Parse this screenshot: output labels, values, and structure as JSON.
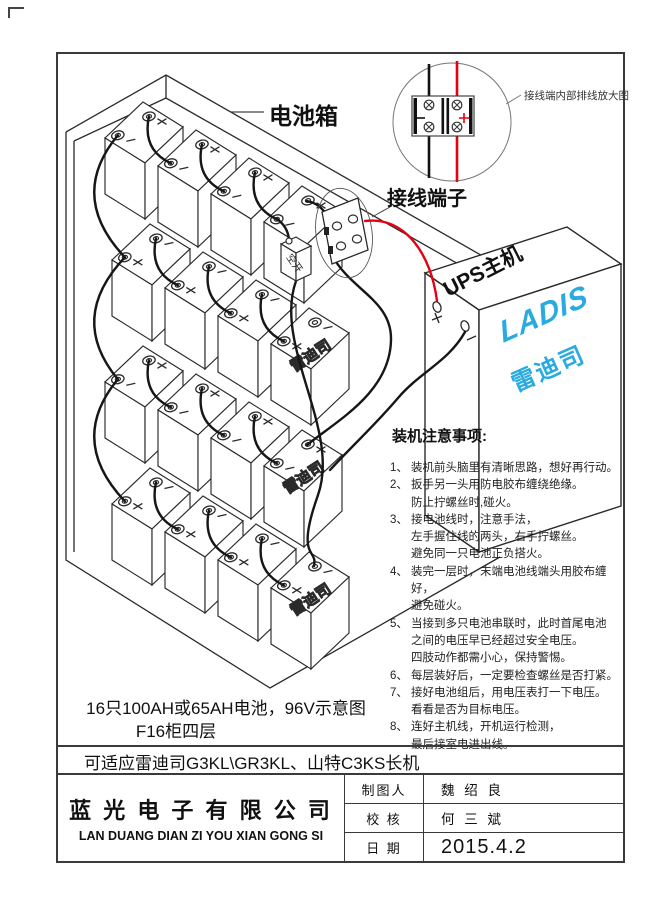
{
  "page": {
    "colors": {
      "line": "#2a2a2a",
      "red_wire": "#e60014",
      "brand_blue": "#29abe2"
    },
    "detail_view": {
      "label": "接线端内部排线放大图",
      "minus": "−",
      "plus": "+"
    },
    "battery_box": {
      "label": "电池箱",
      "battery_brand": "雷迪司"
    },
    "terminal_block": {
      "label": "接线端子"
    },
    "breaker": {
      "label": "空开"
    },
    "ups": {
      "top_label": "UPS主机",
      "logo": "LADIS",
      "brand": "雷迪司",
      "plus": "+",
      "minus": "−"
    },
    "notes": {
      "title": "装机注意事项:",
      "items": [
        {
          "num": "1、",
          "lines": [
            "装机前头脑里有清晰思路，想好再行动。"
          ]
        },
        {
          "num": "2、",
          "lines": [
            "扳手另一头用防电胶布缠绕绝缘。",
            "防止拧螺丝时,碰火。"
          ]
        },
        {
          "num": "3、",
          "lines": [
            "接电池线时，注意手法，",
            "左手握住线的两头，右手拧螺丝。",
            "避免同一只电池正负搭火。"
          ]
        },
        {
          "num": "4、",
          "lines": [
            "装完一层时，末端电池线端头用胶布缠好，",
            "避免碰火。"
          ]
        },
        {
          "num": "5、",
          "lines": [
            "当接到多只电池串联时，此时首尾电池",
            "之间的电压早已经超过安全电压。",
            "四肢动作都需小心，保持警惕。"
          ]
        },
        {
          "num": "6、",
          "lines": [
            "每层装好后，一定要检查螺丝是否打紧。"
          ]
        },
        {
          "num": "7、",
          "lines": [
            "接好电池组后，用电压表打一下电压。",
            "看看是否为目标电压。"
          ]
        },
        {
          "num": "8、",
          "lines": [
            "连好主机线，开机运行检测，",
            "最后接室电进出线。"
          ]
        }
      ]
    },
    "captions": {
      "line1": "16只100AH或65AH电池，96V示意图",
      "line2": "F16柜四层",
      "compat": "可适应雷迪司G3KL\\GR3KL、山特C3KS长机"
    },
    "title_block": {
      "company_cn": "蓝 光 电 子 有 限 公 司",
      "company_en": "LAN DUANG DIAN ZI YOU XIAN GONG SI",
      "rows": [
        {
          "label": "制图人",
          "value": "魏 绍 良"
        },
        {
          "label": "校 核",
          "value": "何 三 斌"
        },
        {
          "label": "日 期",
          "value": "2015.4.2"
        }
      ]
    }
  }
}
